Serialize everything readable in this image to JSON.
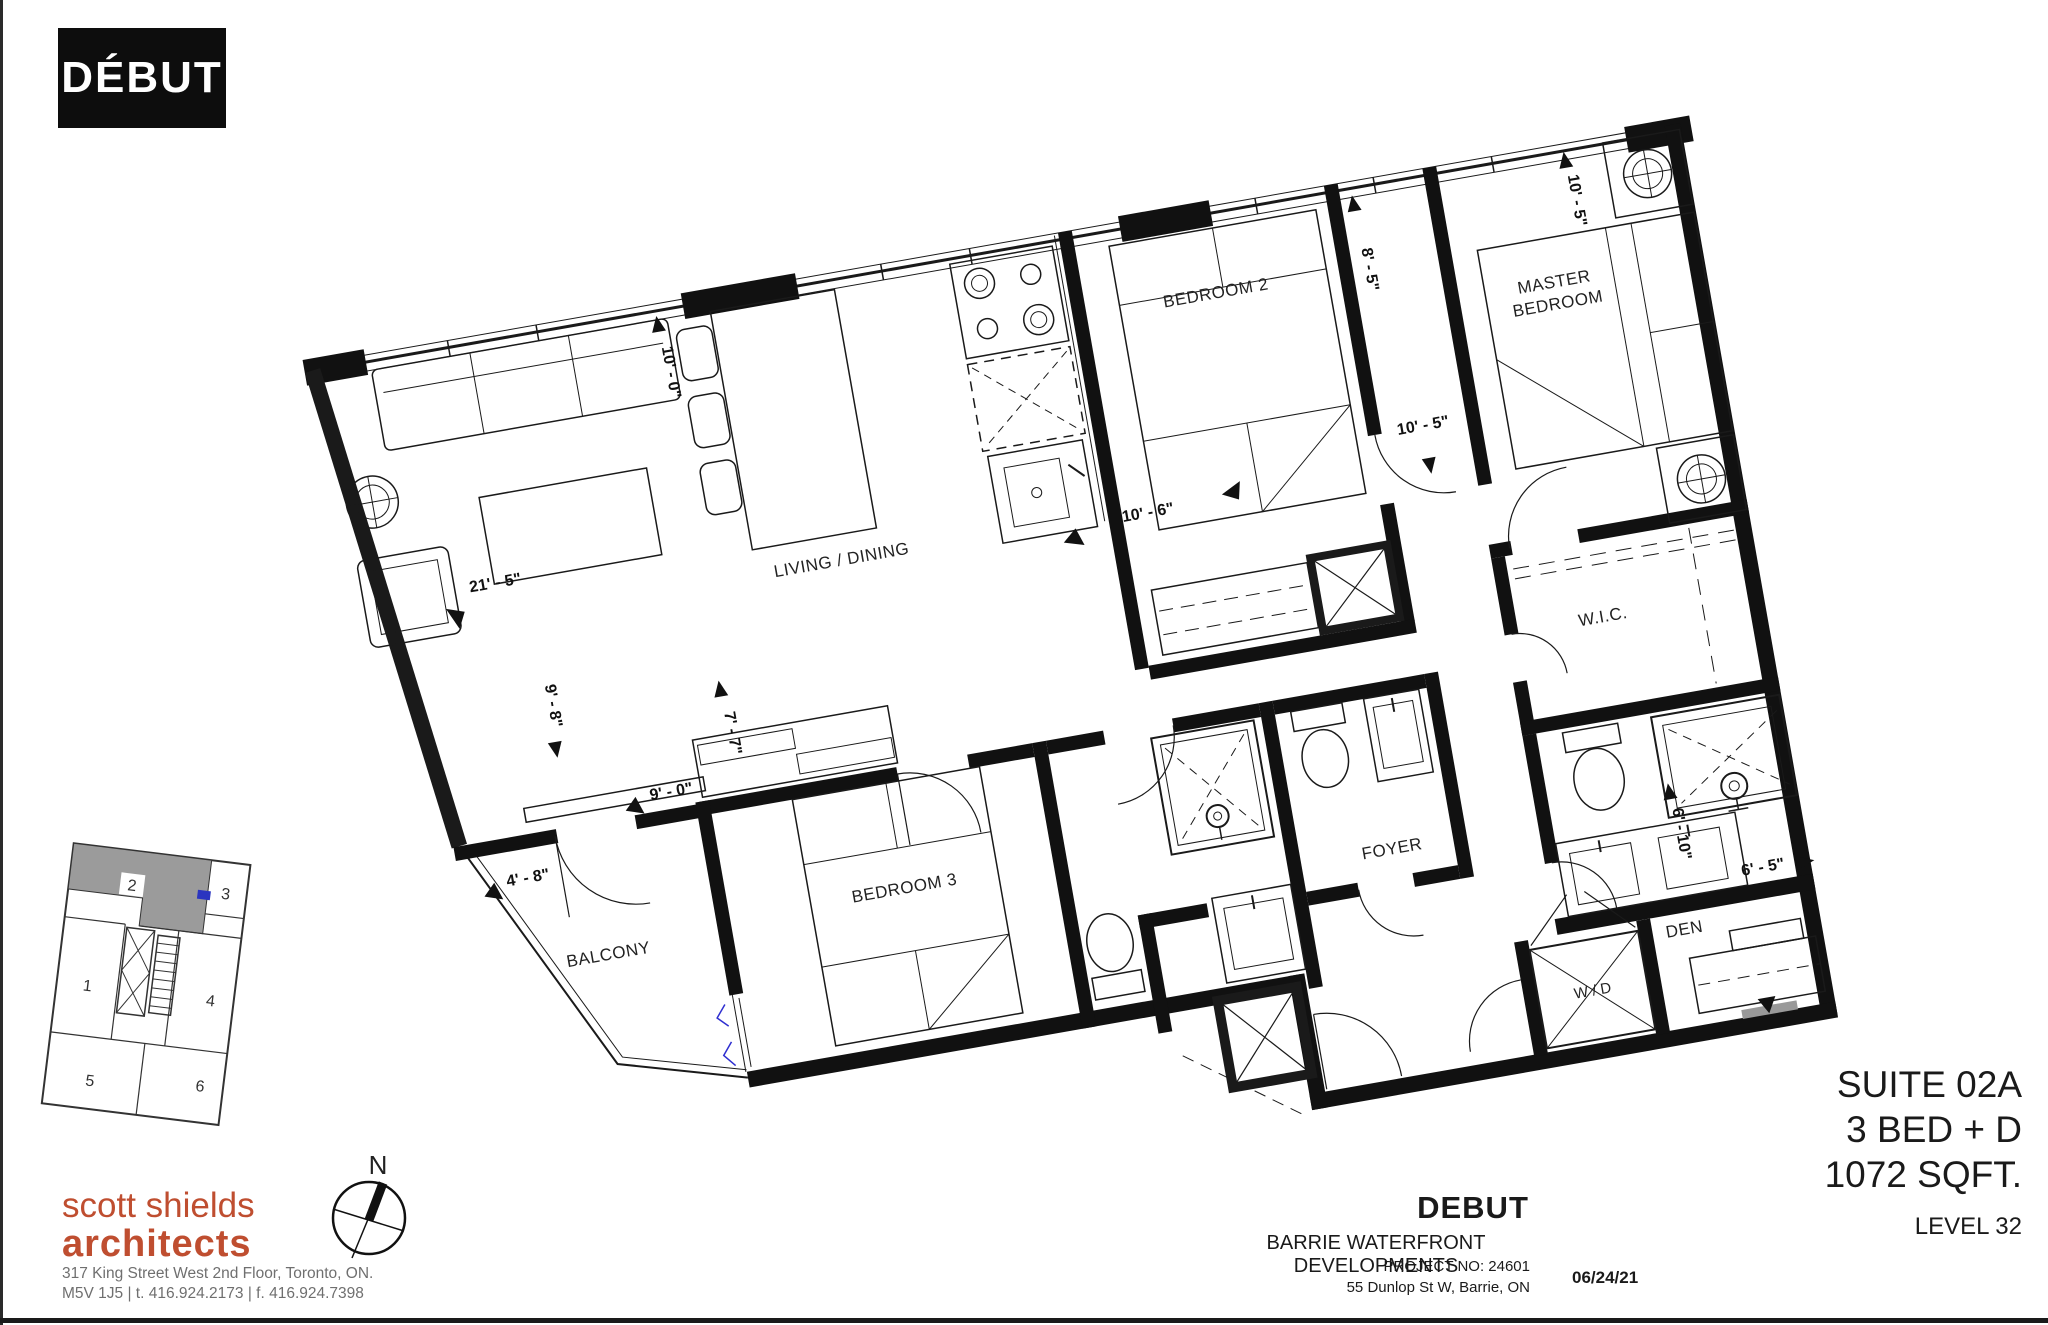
{
  "branding": {
    "logo_text": "DÉBUT",
    "logo_bg": "#0d0d0d",
    "accent_color": "#bf4e30"
  },
  "suite": {
    "name": "SUITE 02A",
    "type": "3 BED + D",
    "area": "1072 SQFT.",
    "level": "LEVEL 32"
  },
  "title_block": {
    "project_name": "DEBUT",
    "development": "BARRIE WATERFRONT DEVELOPMENTS",
    "project_no": "PROJECT NO:  24601",
    "address": "55 Dunlop St W, Barrie, ON",
    "date": "06/24/21"
  },
  "architect": {
    "name_line1": "scott shields",
    "name_line2": "architects",
    "address_line1": "317 King Street West 2nd Floor, Toronto, ON.",
    "address_line2": "M5V  1J5  |  t. 416.924.2173  |  f. 416.924.7398",
    "text_gray": "#6f6f6f"
  },
  "compass": {
    "north_label": "N"
  },
  "plan": {
    "rooms": {
      "living_dining": "LIVING / DINING",
      "bedroom2": "BEDROOM 2",
      "master_line1": "MASTER",
      "master_line2": "BEDROOM",
      "bedroom3": "BEDROOM 3",
      "balcony": "BALCONY",
      "wic": "W.I.C.",
      "foyer": "FOYER",
      "den": "DEN",
      "wd": "W / D"
    },
    "dimensions": {
      "living_wall": "21' - 5\"",
      "living_depth": "10' - 0\"",
      "bedroom2_width": "10' - 6\"",
      "bedroom2_depth": "8' - 5\"",
      "master_width": "10' - 5\"",
      "master_depth": "10' - 5\"",
      "balcony_depth": "9' - 8\"",
      "balcony_width": "4' - 8\"",
      "bedroom3_width": "9' - 0\"",
      "bedroom3_depth": "7' - 7\"",
      "den_depth": "6' - 10\"",
      "den_width": "6' - 5\""
    },
    "marker_blue": "#2f2fd0"
  },
  "keyplan": {
    "units": [
      "1",
      "2",
      "3",
      "4",
      "5",
      "6"
    ],
    "highlighted_unit": "2",
    "highlight_color": "#9b9b9b"
  }
}
